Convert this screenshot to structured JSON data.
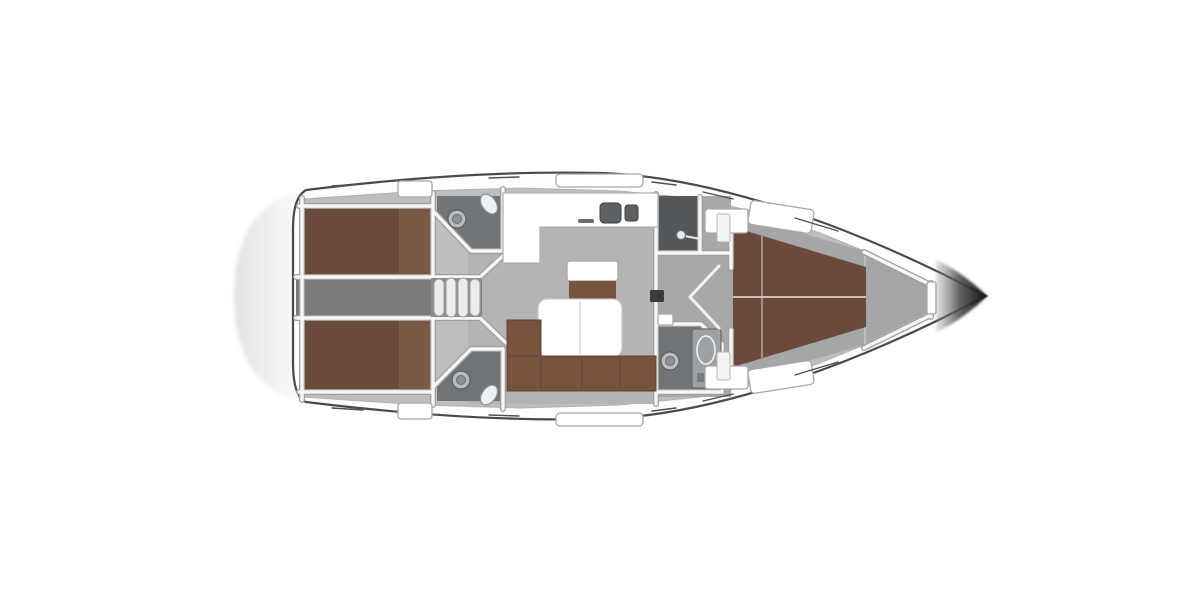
{
  "canvas": {
    "width": 1200,
    "height": 600,
    "background": "#ffffff"
  },
  "colors": {
    "hull_fill": "#fdfdfd",
    "hull_outline": "#4a4a4a",
    "bow_tip_dark": "#141414",
    "stern_platform_edge": "#dddddd",
    "interior_base": "#bcbec0",
    "salon_floor": "#b2b4b6",
    "corridor_floor": "#7a7c7e",
    "mid_floor": "#a6a8aa",
    "forward_floor": "#a4a6a8",
    "anchor_locker": "#a4a6a8",
    "head_floor": "#717477",
    "shower_floor": "#54575a",
    "berth_brown": "#6b4a3b",
    "berth_brown_light": "#7c5846",
    "sofa_brown": "#78543f",
    "wall_fill": "#f7f7f7",
    "wall_edge": "#9f9f9f",
    "fixture_fill": "#ffffff",
    "sink_basin": "#5e6164",
    "fitting_dark": "#3b3b3b",
    "stair_tread": "#ececec",
    "stair_well": "#8a8c8e"
  },
  "icons": {
    "toilet": "toilet-icon",
    "sink": "sink-icon",
    "shower": "shower-head-icon",
    "door_swing": "door-swing-icon",
    "stairs": "companionway-stairs-icon",
    "mast": "mast-step-icon"
  }
}
